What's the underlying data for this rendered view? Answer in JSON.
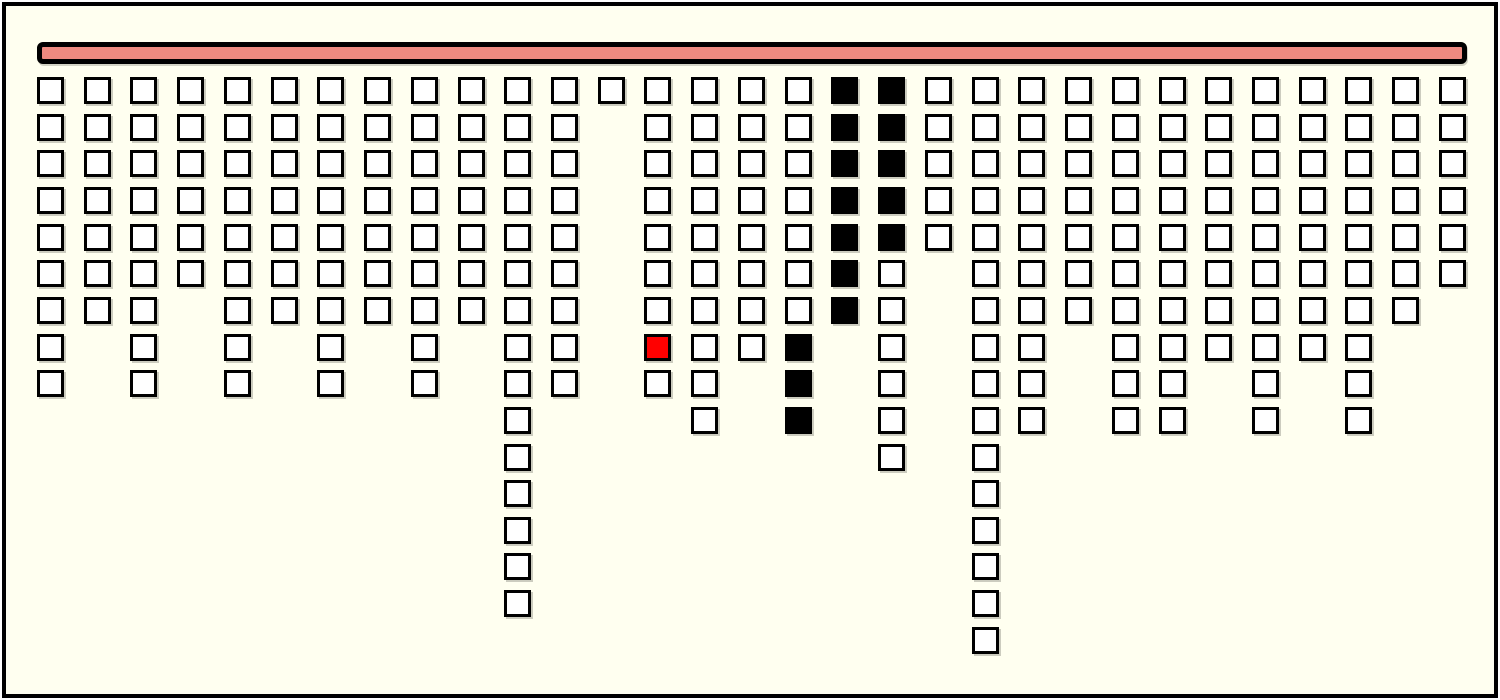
{
  "window": {
    "width": 1500,
    "height": 700,
    "outer_background": "#ffffff",
    "panel_background": "#fffff0",
    "frame_border_color": "#000000"
  },
  "top_bar": {
    "fill_color": "#ee8a80",
    "border_color": "#000000"
  },
  "cell_states": {
    "W": {
      "name": "empty",
      "color": "#ffffff"
    },
    "B": {
      "name": "filled",
      "color": "#000000"
    },
    "R": {
      "name": "highlight",
      "color": "#ff0000"
    }
  },
  "grid": {
    "column_count": 31,
    "total_cells": 266,
    "columns": [
      "WWWWWWWWW",
      "WWWWWWW",
      "WWWWWWWWW",
      "WWWWWW",
      "WWWWWWWWW",
      "WWWWWWW",
      "WWWWWWWWW",
      "WWWWWWW",
      "WWWWWWWWW",
      "WWWWWWW",
      "WWWWWWWWWWWWWWW",
      "WWWWWWWWW",
      "W",
      "WWWWWWWRW",
      "WWWWWWWWWW",
      "WWWWWWWW",
      "WWWWWWWBBB",
      "BBBBBBB",
      "BBBBBWWWWWW",
      "WWWWW",
      "WWWWWWWWWWWWWWWW",
      "WWWWWWWWWW",
      "WWWWWWW",
      "WWWWWWWWWW",
      "WWWWWWWWWW",
      "WWWWWWWW",
      "WWWWWWWWWW",
      "WWWWWWWW",
      "WWWWWWWWWW",
      "WWWWWWW",
      "WWWWWW"
    ]
  }
}
